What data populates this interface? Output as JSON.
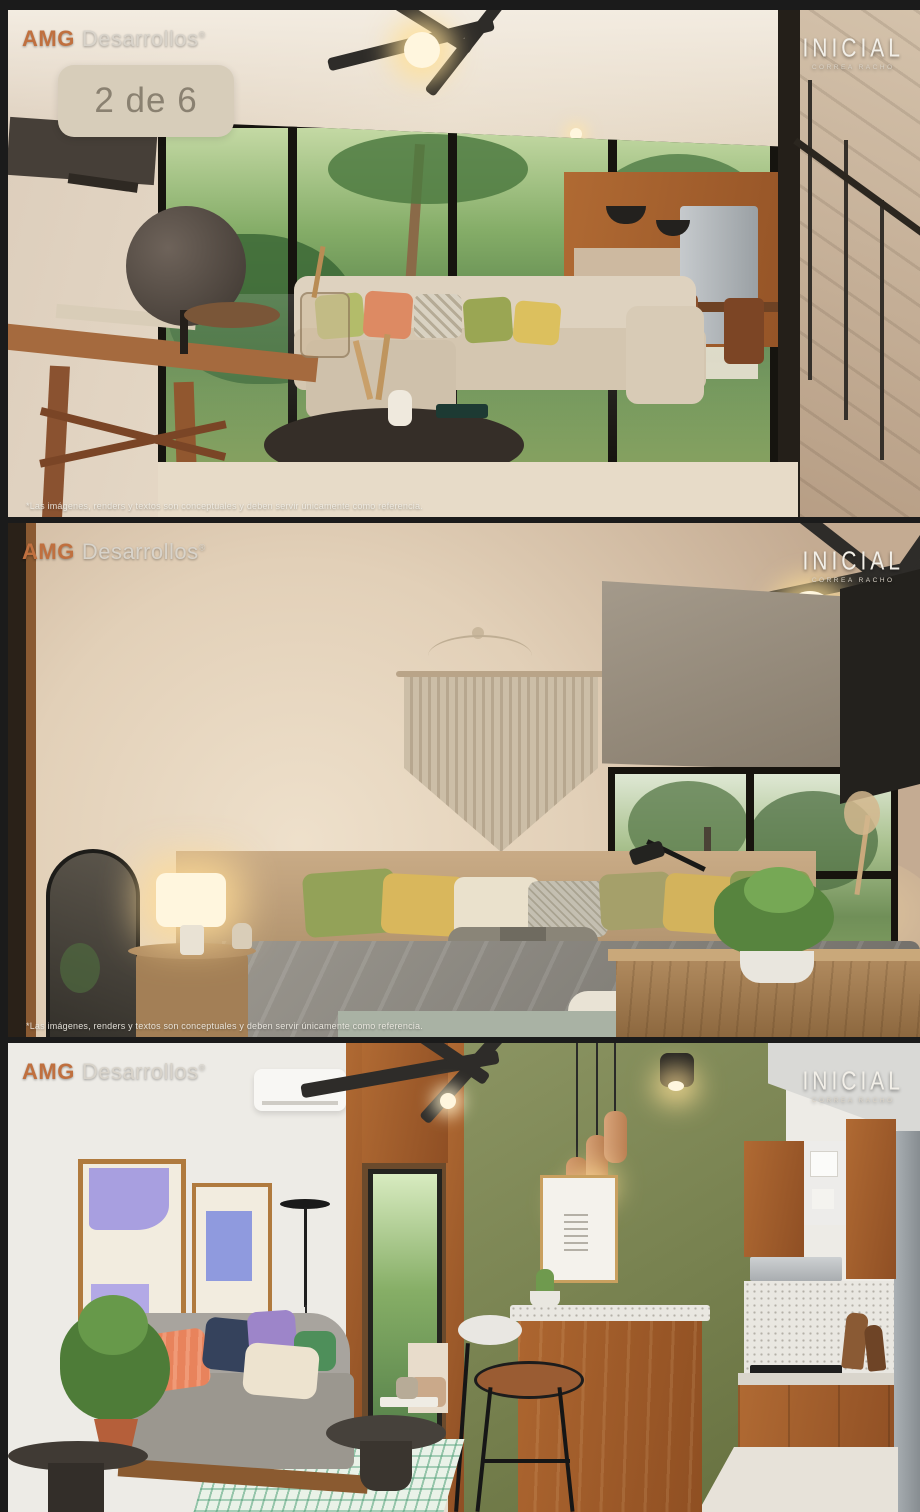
{
  "screen": {
    "background": "#1b1b1b"
  },
  "branding": {
    "amg": {
      "prefix": "AMG",
      "suffix": "Desarrollos",
      "registered": "®"
    },
    "inicial": {
      "title": "INICIAL",
      "subtitle": "CORREA RACHO"
    }
  },
  "carousel": {
    "counter": "2 de 6"
  },
  "legal": {
    "disclaimer": "*Las imágenes, renders y textos son conceptuales y deben servir únicamente como referencia."
  },
  "colors": {
    "background": "#1b1b1b",
    "badge_bg": "#d7cdba",
    "badge_text": "#8a8171",
    "amg_orange": "#c0703f",
    "logo_light": "#d8d3ca",
    "inicial_white": "#f2efe8",
    "green_wall": "#77814f",
    "wood": "#a9612e",
    "lavender_art": "#a79ee0",
    "rug_mint": "#bfe0c4",
    "sofa_gray": "#a3a09a",
    "garden_green": "#5e8b4f"
  }
}
